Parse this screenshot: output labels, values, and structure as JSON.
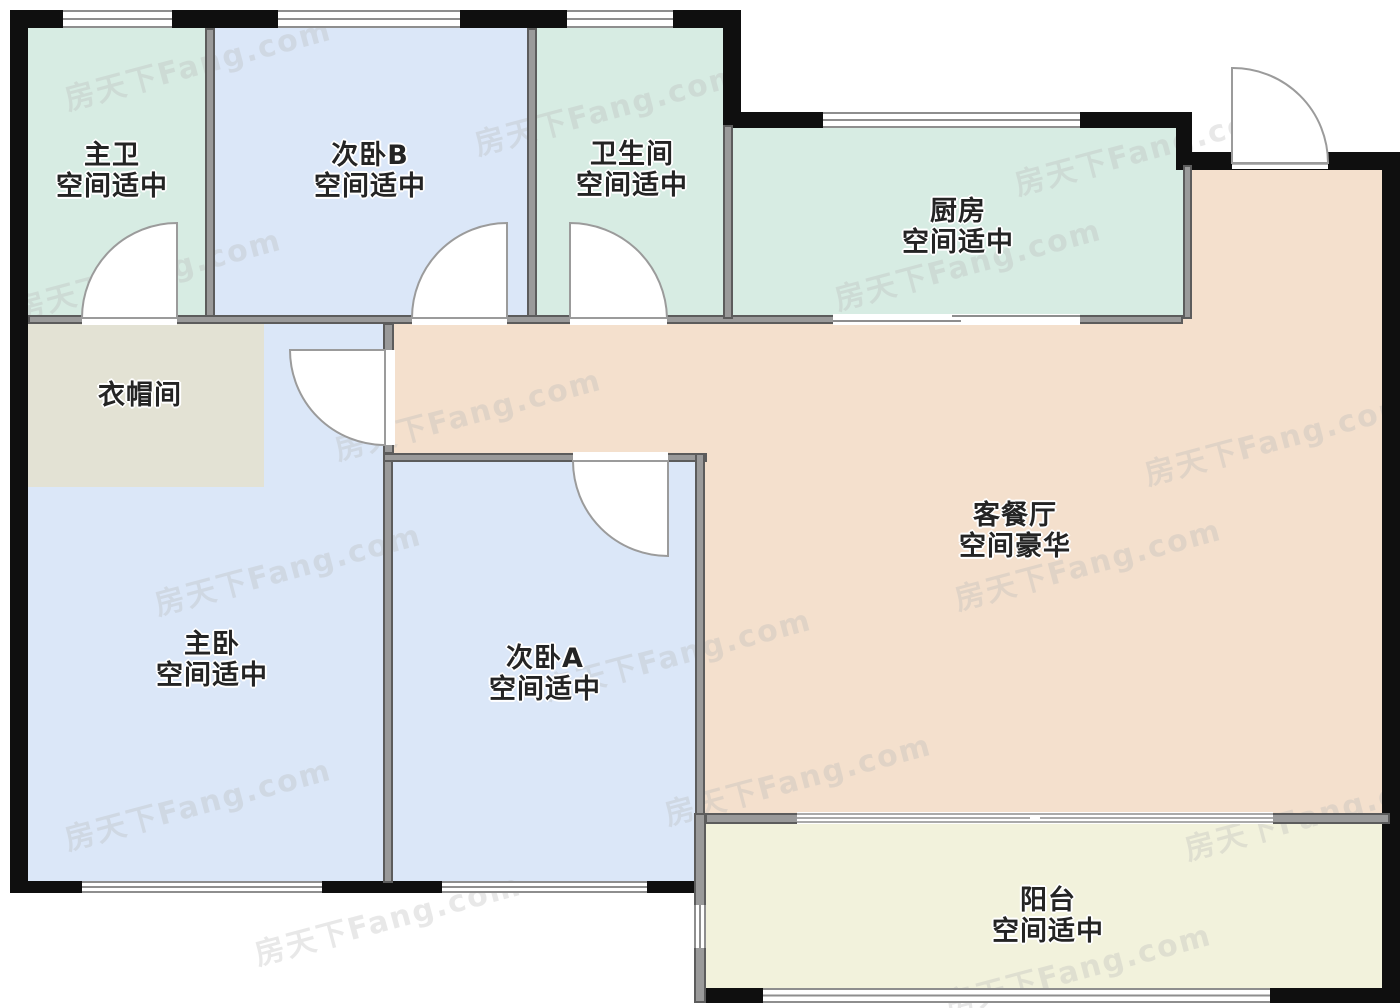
{
  "watermark": {
    "text": "房天下Fang.com"
  },
  "palette": {
    "wall_exterior": "#0f0f0f",
    "wall_interior": "#9a9a9a",
    "wall_interior_edge": "#5c5c5c",
    "room_bath_green": "#d7ece3",
    "room_bedroom_blue": "#dbe7f8",
    "room_cloak_beige": "#e3e2d4",
    "room_living_peach": "#f4e0cd",
    "room_balcony_yellow": "#f2f2dc",
    "door_line": "#9b9b9b",
    "window_line": "#8e8e8e",
    "label_text": "#242424"
  },
  "rooms": [
    {
      "name": "主卫",
      "desc": "空间适中"
    },
    {
      "name": "次卧B",
      "desc": "空间适中"
    },
    {
      "name": "卫生间",
      "desc": "空间适中"
    },
    {
      "name": "厨房",
      "desc": "空间适中"
    },
    {
      "name": "衣帽间",
      "desc": ""
    },
    {
      "name": "客餐厅",
      "desc": "空间豪华"
    },
    {
      "name": "主卧",
      "desc": "空间适中"
    },
    {
      "name": "次卧A",
      "desc": "空间适中"
    },
    {
      "name": "阳台",
      "desc": "空间适中"
    }
  ]
}
